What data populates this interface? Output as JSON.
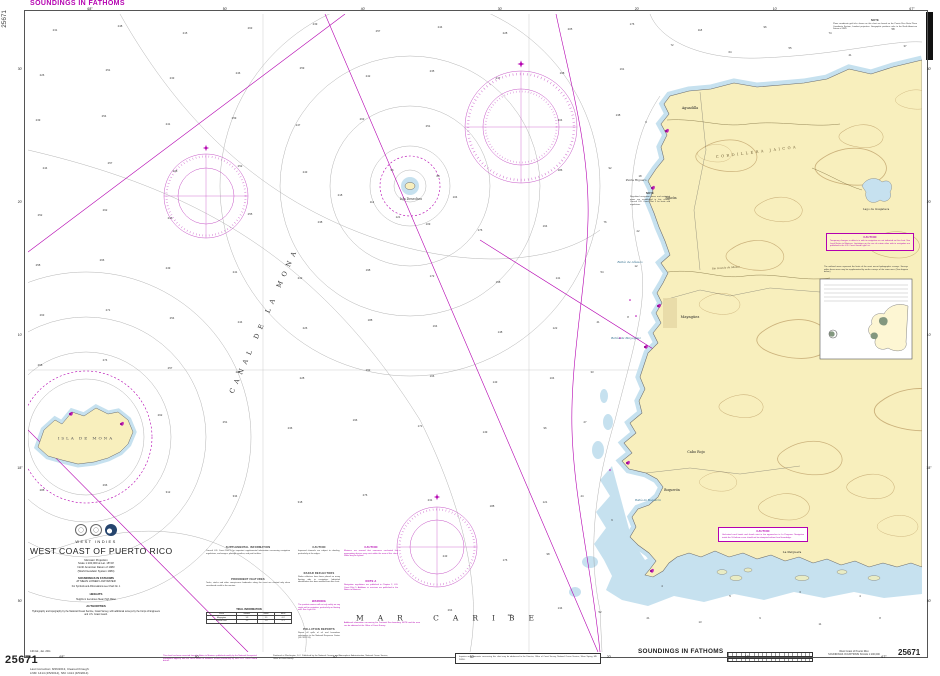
{
  "page": {
    "chart_number": "25671"
  },
  "colors": {
    "magenta": "#b400b0",
    "land": "#f8efbd",
    "shallow": "#c6e1ef",
    "contour_gray": "#8f8f8f",
    "land_contour": "#b5935a"
  },
  "margin": {
    "top_left_title": "SOUNDINGS IN FATHOMS",
    "side_chart_number": "25671",
    "bottom_left_number": "25671",
    "edition_note": "14th Ed., Jan. 2011",
    "correction_line1": "Last Correction: 8/26/2013,  Cleared through:",
    "correction_line2": "LNM: 1414 (4/5/2014),  NM: 1414 (4/5/2014)",
    "bottom_soundings_title": "SOUNDINGS IN FATHOMS",
    "bottom_chart_title": "West Coast of Puerto Rico",
    "bottom_chart_scale": "SOUNDINGS IN FATHOMS   SCALE 1:100,000",
    "bottom_right_number": "25671"
  },
  "title_block": {
    "region": "WEST INDIES",
    "title": "WEST COAST OF PUERTO RICO",
    "projection": "Mercator Projection",
    "scale": "Scale 1:100,000 at Lat. 18°20'",
    "datum": "North American Datum of 1983",
    "datum2": "(World Geodetic System 1984)",
    "soundings1": "SOUNDINGS IN FATHOMS",
    "soundings2": "AT MEAN LOWER LOW WATER",
    "symbols_ref": "For Symbols and Abbreviations see Chart No. 1",
    "heights_heading": "HEIGHTS",
    "heights": "Heights in feet above Mean High Water",
    "authorities_heading": "AUTHORITIES",
    "authorities": "Hydrography and topography by the National Ocean Service, Coast Survey, with additional surveys by the Corps of Engineers and U.S. Coast Guard."
  },
  "border": {
    "top_labels": [
      [
        "68°",
        62
      ],
      [
        "50'",
        197
      ],
      [
        "40'",
        335
      ],
      [
        "30'",
        472
      ],
      [
        "20'",
        609
      ],
      [
        "10'",
        747
      ],
      [
        "67°",
        884
      ]
    ],
    "bottom_labels": [
      [
        "68°",
        62
      ],
      [
        "50'",
        197
      ],
      [
        "40'",
        335
      ],
      [
        "30'",
        472
      ],
      [
        "20'",
        609
      ],
      [
        "10'",
        747
      ],
      [
        "67°",
        884
      ]
    ],
    "left_labels": [
      [
        "30'",
        55
      ],
      [
        "20'",
        188
      ],
      [
        "10'",
        321
      ],
      [
        "18°",
        454
      ],
      [
        "50'",
        587
      ]
    ],
    "right_labels": [
      [
        "30'",
        55
      ],
      [
        "20'",
        188
      ],
      [
        "10'",
        321
      ],
      [
        "18°",
        454
      ],
      [
        "50'",
        587
      ]
    ]
  },
  "sea_labels": [
    {
      "t": "CANAL DE LA MONA",
      "x": 264,
      "y": 320,
      "s": 6.5,
      "ls": 5.5,
      "c": "#333",
      "rot": -66
    },
    {
      "t": "MAR CARIBE",
      "x": 452,
      "y": 618,
      "s": 7.5,
      "ls": 14,
      "c": "#333"
    },
    {
      "t": "ISLA DE MONA",
      "x": 86,
      "y": 438,
      "s": 4,
      "ls": 2,
      "c": "#555"
    },
    {
      "t": "Isla Desecheo",
      "x": 411,
      "y": 199,
      "s": 3.2,
      "c": "#333"
    },
    {
      "t": "CORDILLERA JAICOA",
      "x": 757,
      "y": 152,
      "s": 3.6,
      "ls": 2.5,
      "c": "#6b5a33",
      "rot": -7
    },
    {
      "t": "Lago de Guajataca",
      "x": 876,
      "y": 209,
      "s": 2.8,
      "c": "#333"
    },
    {
      "t": "Aguadilla",
      "x": 690,
      "y": 108,
      "s": 3.4,
      "c": "#222"
    },
    {
      "t": "Rincón",
      "x": 671,
      "y": 198,
      "s": 3.2,
      "c": "#222"
    },
    {
      "t": "Mayagüez",
      "x": 690,
      "y": 317,
      "s": 3.6,
      "c": "#222"
    },
    {
      "t": "Cabo Rojo",
      "x": 696,
      "y": 452,
      "s": 3.4,
      "c": "#222"
    },
    {
      "t": "Boquerón",
      "x": 672,
      "y": 490,
      "s": 3.2,
      "c": "#222"
    },
    {
      "t": "La Parguera",
      "x": 792,
      "y": 552,
      "s": 3,
      "c": "#222"
    },
    {
      "t": "Punta Higuero",
      "x": 636,
      "y": 180,
      "s": 2.8,
      "c": "#333"
    },
    {
      "t": "Bahía de Añasco",
      "x": 630,
      "y": 262,
      "s": 3,
      "c": "#2b6a8a",
      "i": 1
    },
    {
      "t": "Bahía de Mayagüez",
      "x": 626,
      "y": 338,
      "s": 3,
      "c": "#2b6a8a",
      "i": 1
    },
    {
      "t": "Bahía de Boquerón",
      "x": 648,
      "y": 500,
      "s": 2.7,
      "c": "#2b6a8a",
      "i": 1
    },
    {
      "t": "Río Grande de Añasco",
      "x": 726,
      "y": 268,
      "s": 2.5,
      "c": "#5a4a2a",
      "i": 1,
      "rot": -4
    }
  ],
  "soundings": [
    [
      55,
      30,
      "231"
    ],
    [
      120,
      26,
      "248"
    ],
    [
      185,
      33,
      "215"
    ],
    [
      250,
      28,
      "263"
    ],
    [
      315,
      24,
      "239"
    ],
    [
      378,
      31,
      "257"
    ],
    [
      440,
      27,
      "244"
    ],
    [
      505,
      33,
      "228"
    ],
    [
      570,
      29,
      "205"
    ],
    [
      632,
      24,
      "176"
    ],
    [
      700,
      30,
      "118"
    ],
    [
      765,
      27,
      "96"
    ],
    [
      830,
      33,
      "74"
    ],
    [
      893,
      29,
      "58"
    ],
    [
      42,
      75,
      "226"
    ],
    [
      108,
      70,
      "251"
    ],
    [
      172,
      78,
      "233"
    ],
    [
      238,
      73,
      "246"
    ],
    [
      302,
      68,
      "259"
    ],
    [
      368,
      76,
      "242"
    ],
    [
      432,
      71,
      "235"
    ],
    [
      498,
      78,
      "217"
    ],
    [
      562,
      73,
      "198"
    ],
    [
      622,
      69,
      "161"
    ],
    [
      672,
      45,
      "72"
    ],
    [
      730,
      52,
      "64"
    ],
    [
      790,
      48,
      "55"
    ],
    [
      850,
      55,
      "41"
    ],
    [
      905,
      46,
      "37"
    ],
    [
      38,
      120,
      "239"
    ],
    [
      104,
      116,
      "254"
    ],
    [
      168,
      124,
      "241"
    ],
    [
      234,
      118,
      "259"
    ],
    [
      298,
      125,
      "247"
    ],
    [
      362,
      119,
      "263"
    ],
    [
      428,
      126,
      "251"
    ],
    [
      560,
      120,
      "204"
    ],
    [
      618,
      115,
      "138"
    ],
    [
      646,
      122,
      "9"
    ],
    [
      45,
      168,
      "244"
    ],
    [
      110,
      163,
      "257"
    ],
    [
      175,
      171,
      "238"
    ],
    [
      240,
      166,
      "252"
    ],
    [
      305,
      172,
      "243"
    ],
    [
      340,
      195,
      "218"
    ],
    [
      392,
      170,
      "96"
    ],
    [
      438,
      176,
      "88"
    ],
    [
      455,
      197,
      "104"
    ],
    [
      372,
      202,
      "112"
    ],
    [
      398,
      217,
      "121"
    ],
    [
      428,
      224,
      "109"
    ],
    [
      560,
      170,
      "186"
    ],
    [
      610,
      168,
      "92"
    ],
    [
      640,
      176,
      "18"
    ],
    [
      40,
      215,
      "252"
    ],
    [
      105,
      210,
      "262"
    ],
    [
      170,
      218,
      "246"
    ],
    [
      250,
      214,
      "255"
    ],
    [
      320,
      222,
      "238"
    ],
    [
      480,
      230,
      "176"
    ],
    [
      545,
      226,
      "164"
    ],
    [
      605,
      222,
      "76"
    ],
    [
      638,
      231,
      "22"
    ],
    [
      38,
      265,
      "258"
    ],
    [
      102,
      260,
      "266"
    ],
    [
      168,
      268,
      "249"
    ],
    [
      235,
      272,
      "241"
    ],
    [
      300,
      278,
      "232"
    ],
    [
      368,
      270,
      "198"
    ],
    [
      432,
      276,
      "172"
    ],
    [
      498,
      282,
      "158"
    ],
    [
      558,
      278,
      "141"
    ],
    [
      602,
      272,
      "54"
    ],
    [
      636,
      266,
      "12"
    ],
    [
      42,
      315,
      "263"
    ],
    [
      108,
      310,
      "271"
    ],
    [
      172,
      318,
      "254"
    ],
    [
      240,
      322,
      "244"
    ],
    [
      305,
      328,
      "226"
    ],
    [
      370,
      320,
      "188"
    ],
    [
      435,
      326,
      "164"
    ],
    [
      500,
      332,
      "148"
    ],
    [
      555,
      328,
      "122"
    ],
    [
      598,
      322,
      "41"
    ],
    [
      628,
      317,
      "8"
    ],
    [
      40,
      365,
      "268"
    ],
    [
      105,
      360,
      "274"
    ],
    [
      170,
      368,
      "257"
    ],
    [
      238,
      372,
      "247"
    ],
    [
      302,
      378,
      "228"
    ],
    [
      368,
      370,
      "192"
    ],
    [
      432,
      376,
      "166"
    ],
    [
      495,
      382,
      "143"
    ],
    [
      552,
      378,
      "104"
    ],
    [
      592,
      372,
      "33"
    ],
    [
      160,
      415,
      "262"
    ],
    [
      225,
      422,
      "251"
    ],
    [
      290,
      428,
      "236"
    ],
    [
      355,
      420,
      "196"
    ],
    [
      420,
      426,
      "171"
    ],
    [
      485,
      432,
      "149"
    ],
    [
      545,
      428,
      "96"
    ],
    [
      585,
      422,
      "27"
    ],
    [
      42,
      490,
      "288"
    ],
    [
      105,
      485,
      "296"
    ],
    [
      168,
      492,
      "312"
    ],
    [
      235,
      496,
      "334"
    ],
    [
      300,
      502,
      "318"
    ],
    [
      365,
      495,
      "276"
    ],
    [
      430,
      500,
      "231"
    ],
    [
      492,
      506,
      "188"
    ],
    [
      545,
      502,
      "121"
    ],
    [
      582,
      496,
      "44"
    ],
    [
      445,
      556,
      "243"
    ],
    [
      505,
      560,
      "176"
    ],
    [
      548,
      554,
      "98"
    ],
    [
      450,
      610,
      "264"
    ],
    [
      510,
      615,
      "207"
    ],
    [
      560,
      608,
      "134"
    ],
    [
      600,
      612,
      "52"
    ],
    [
      648,
      618,
      "21"
    ],
    [
      700,
      622,
      "13"
    ],
    [
      760,
      618,
      "9"
    ],
    [
      820,
      624,
      "11"
    ],
    [
      880,
      618,
      "8"
    ],
    [
      612,
      520,
      "6"
    ],
    [
      662,
      586,
      "4"
    ],
    [
      730,
      596,
      "5"
    ],
    [
      800,
      592,
      "3"
    ],
    [
      860,
      596,
      "4"
    ]
  ],
  "notes": [
    {
      "x": 833,
      "y": 19,
      "w": 84,
      "color": "black",
      "heading": "NOTE",
      "body": "Plane coordinate grid ticks shown on this chart are based on the Puerto Rico State Plane Coordinate System, Lambert projection. Geographic positions refer to the North American Datum of 1983."
    },
    {
      "x": 826,
      "y": 233,
      "w": 80,
      "color": "magenta",
      "boxed": true,
      "bg": "#fdf3cd",
      "heading": "CAUTION",
      "body": "Temporary changes or defects in aids to navigation are not indicated on this chart. See Local Notice to Mariners. Limitations on the use of certain other aids to navigation are published in the U.S. Coast Guard Light List."
    },
    {
      "x": 824,
      "y": 266,
      "w": 84,
      "color": "black",
      "heading": "",
      "body": "The outlined areas represent the limits of the most recent hydrographic surveys. Surveys within these areas may be supplemented by earlier surveys of the same area. (See diagram below.)"
    },
    {
      "x": 630,
      "y": 192,
      "w": 40,
      "color": "black",
      "heading": "NOTE",
      "body": "Regulated navigation areas and restricted areas are established in this vicinity. Consult U.S. Coast Pilot 5 for limits and regulations."
    },
    {
      "x": 718,
      "y": 527,
      "w": 82,
      "color": "magenta",
      "boxed": true,
      "bg": "#ffffff",
      "heading": "CAUTION",
      "body": "Uncharted coral heads and shoals exist in the approaches to La Parguera. Navigation inside the 10-fathom curve should not be attempted without local knowledge."
    },
    {
      "x": 206,
      "y": 546,
      "w": 84,
      "color": "black",
      "heading": "SUPPLEMENTAL INFORMATION",
      "body": "Consult U.S. Coast Pilot 5 for important supplemental information concerning navigation regulations, anchorages, pilotage, weather, and port facilities."
    },
    {
      "x": 206,
      "y": 578,
      "w": 84,
      "color": "black",
      "heading": "PROMINENT FEATURES",
      "body": "Tanks, stacks and other conspicuous landmarks along the coast are charted only when considered useful to the mariner."
    },
    {
      "x": 298,
      "y": 546,
      "w": 42,
      "color": "black",
      "heading": "CAUTION",
      "body": "Improved channels are subject to shoaling, particularly at the edges."
    },
    {
      "x": 298,
      "y": 572,
      "w": 42,
      "color": "black",
      "heading": "RADAR REFLECTORS",
      "body": "Radar reflectors have been placed on many floating aids to navigation. Individual identification has been omitted from this chart."
    },
    {
      "x": 298,
      "y": 600,
      "w": 42,
      "color": "magenta",
      "heading": "WARNING",
      "body": "The prudent mariner will not rely solely on any single aid to navigation, particularly on floating aids. See Light List."
    },
    {
      "x": 298,
      "y": 628,
      "w": 42,
      "color": "black",
      "heading": "POLLUTION REPORTS",
      "body": "Report all spills of oil and hazardous substances to the National Response Center (33 CFR 153)."
    },
    {
      "x": 344,
      "y": 546,
      "w": 54,
      "color": "magenta",
      "heading": "CAUTION",
      "body": "Mariners are warned that numerous uncharted fish aggregating devices may exist within the area of this chart. Some may be lighted."
    },
    {
      "x": 344,
      "y": 580,
      "w": 54,
      "color": "magenta",
      "heading": "NOTE A",
      "body": "Navigation regulations are published in Chapter 2, U.S. Coast Pilot 5. Additions or revisions are published in the Notice to Mariners."
    },
    {
      "x": 344,
      "y": 622,
      "w": 76,
      "color": "magenta",
      "heading": "",
      "body": "Additional information concerning the Territorial Sea boundary, NOTE and the area can be obtained at the Office of Coast Survey."
    },
    {
      "x": 163,
      "y": 655,
      "w": 94,
      "color": "magenta",
      "heading": "",
      "body": "This chart has been corrected from the Notice to Mariners published weekly by the National Geospatial-Intelligence Agency and the Local Notice to Mariners issued periodically by each U.S. Coast Guard district."
    },
    {
      "x": 273,
      "y": 655,
      "w": 115,
      "color": "black",
      "heading": "",
      "body": "Produced at Washington, D.C. Published by the National Oceanic and Atmospheric Administration, National Ocean Service, Office of Coast Survey."
    },
    {
      "x": 455,
      "y": 653,
      "w": 138,
      "color": "black",
      "boxed": true,
      "bg": "#ffffff",
      "heading": "",
      "body": "Inquiries and comments concerning this chart may be addressed to the Director, Office of Coast Survey, National Ocean Service, Silver Spring, MD 20910."
    }
  ],
  "tide_table": {
    "title": "TIDAL INFORMATION",
    "headers": [
      "Place",
      "MHHW",
      "MHW",
      "MLW"
    ],
    "rows": [
      [
        "Mayagüez",
        "1.3",
        "1.1",
        "0.2"
      ],
      [
        "Puerto Real",
        "1.2",
        "1.0",
        "0.1"
      ]
    ]
  },
  "inset": {
    "x": 820,
    "y": 279,
    "w": 92,
    "h": 80,
    "table_rows": 5
  },
  "scale_bar": {
    "label": "NAUTICAL MILES"
  }
}
